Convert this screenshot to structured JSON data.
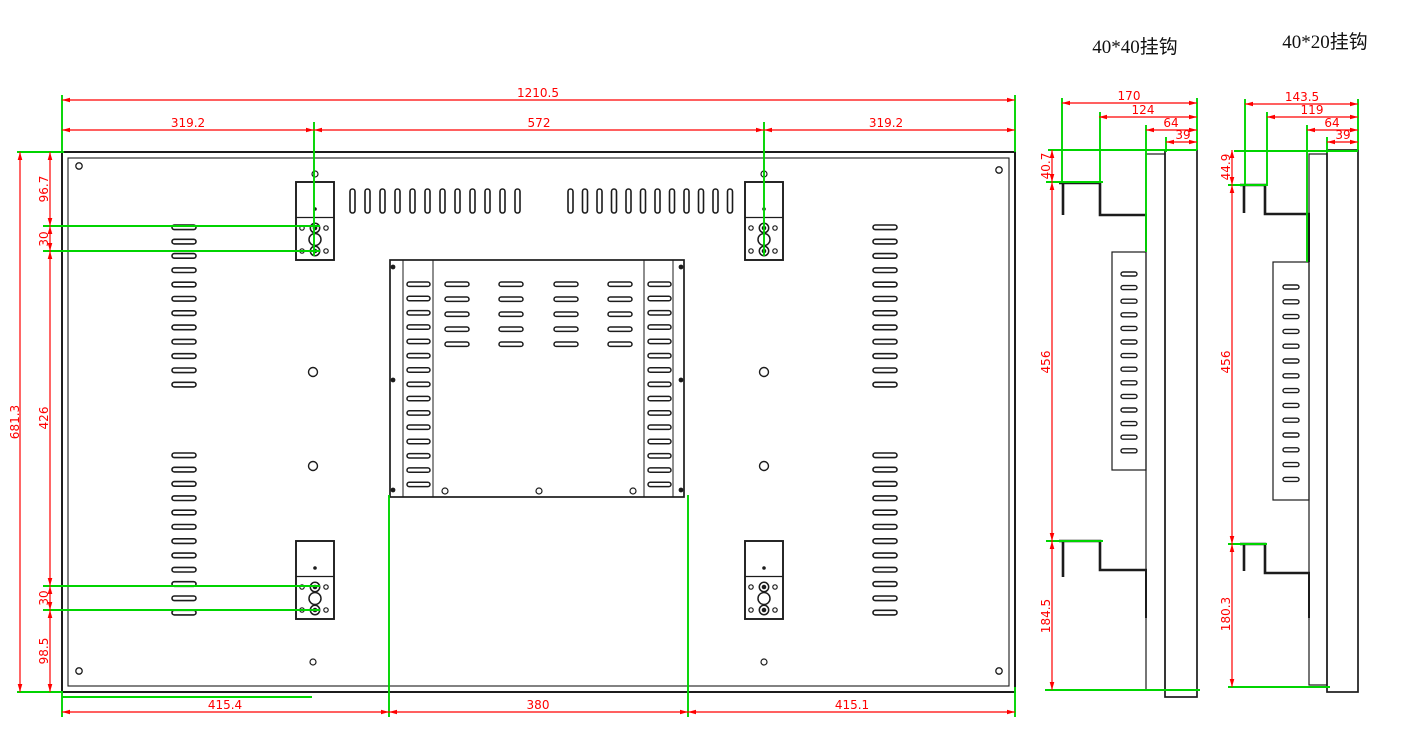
{
  "colors": {
    "dimension_red": "#ff0000",
    "extension_green": "#00d400",
    "line_black": "#1c1c1c",
    "background": "#ffffff"
  },
  "main_view": {
    "dim_top_overall": "1210.5",
    "dim_top_left": "319.2",
    "dim_top_center": "572",
    "dim_top_right": "319.2",
    "dim_left_overall": "681.3",
    "dim_left_top": "96.7",
    "dim_left_hook_pitch_top": "30",
    "dim_left_middle": "426",
    "dim_left_hook_pitch_bottom": "30",
    "dim_left_bottom": "98.5",
    "dim_bottom_left": "415.4",
    "dim_bottom_center": "380",
    "dim_bottom_right": "415.1"
  },
  "hook_view_40x40": {
    "title": "40*40挂钩",
    "dim_width_overall": "170",
    "dim_width_inner": "124",
    "dim_depth": "64",
    "dim_panel_thickness": "39",
    "dim_top_offset": "40.7",
    "dim_hook_span": "456",
    "dim_bottom_offset": "184.5"
  },
  "hook_view_40x20": {
    "title": "40*20挂钩",
    "dim_width_overall": "143.5",
    "dim_width_inner": "119",
    "dim_depth": "64",
    "dim_panel_thickness": "39",
    "dim_top_offset": "44.9",
    "dim_hook_span": "456",
    "dim_bottom_offset": "180.3"
  }
}
